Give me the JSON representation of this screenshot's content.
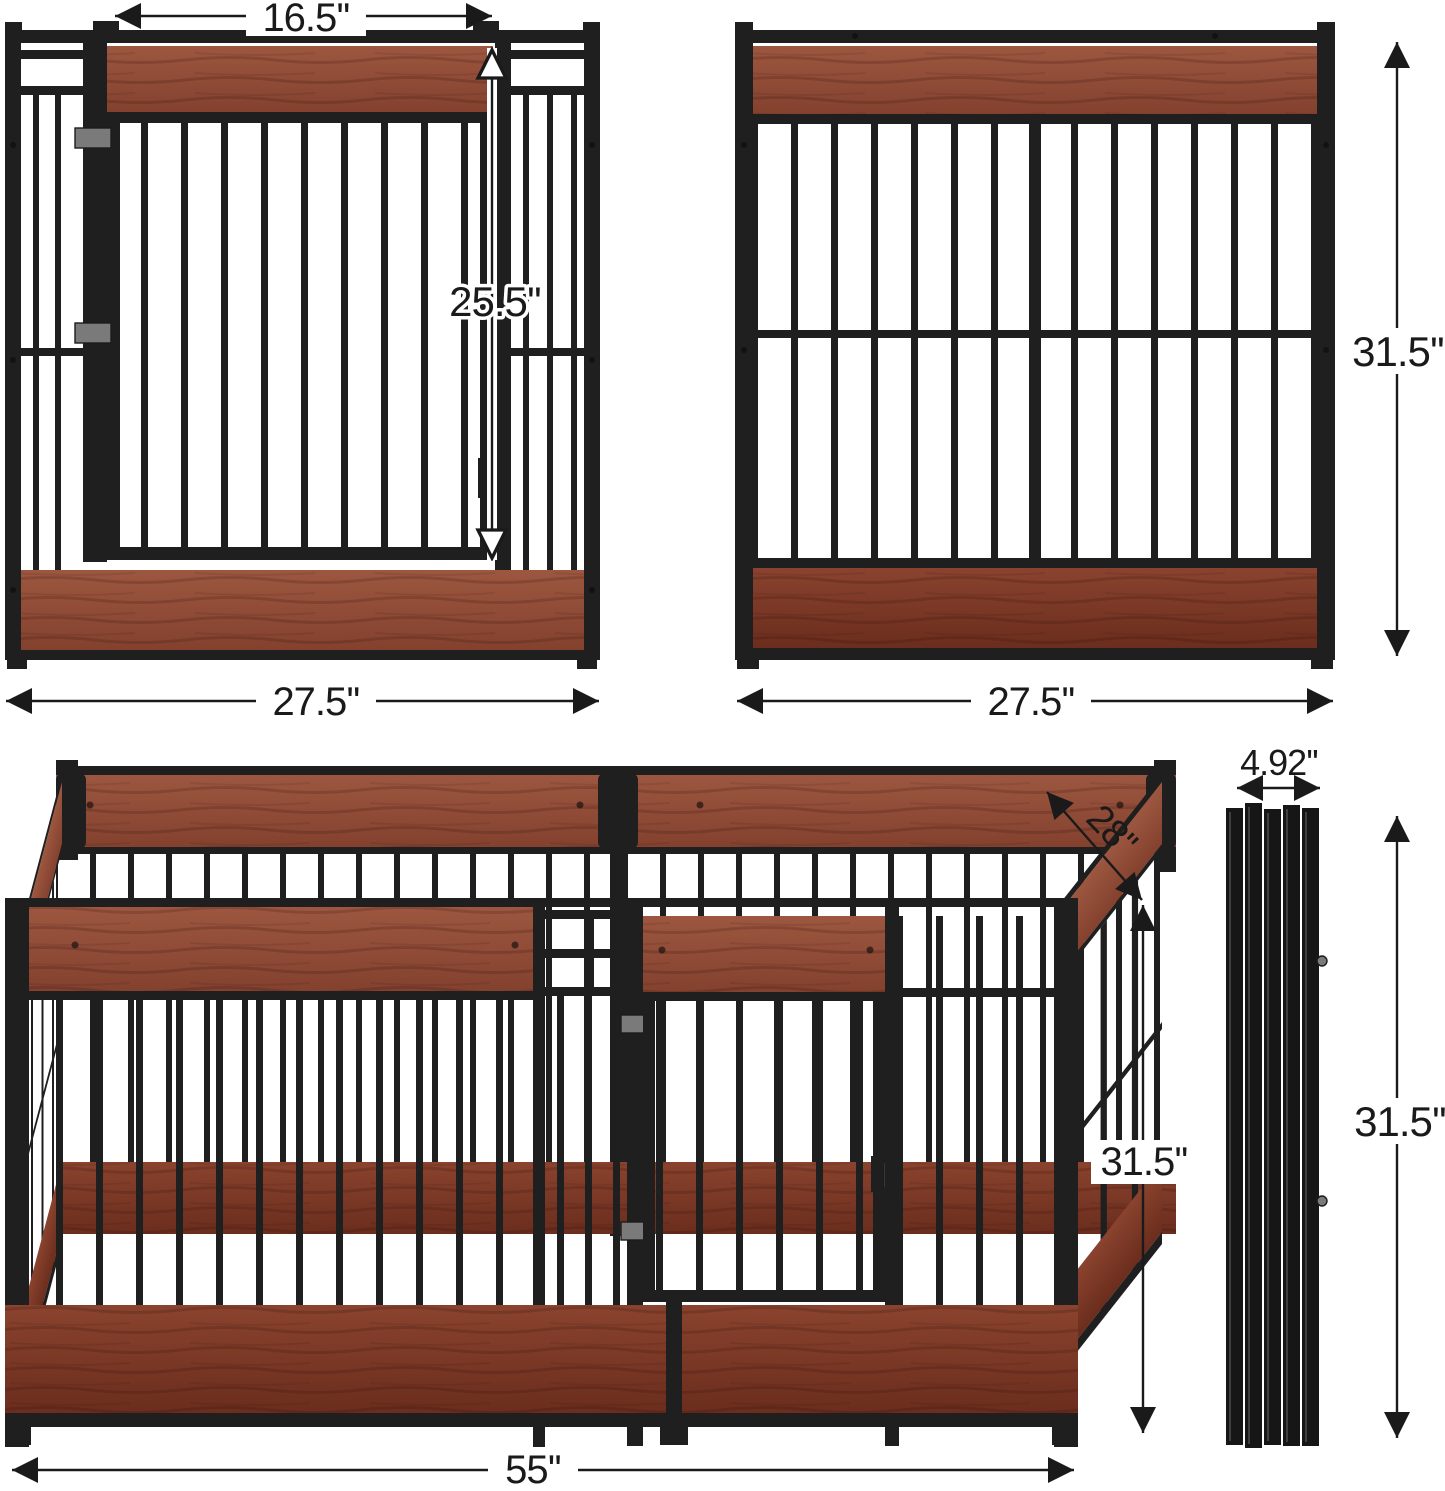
{
  "figure": {
    "description": "Dog crate panel dimension diagram",
    "background": "#ffffff",
    "colors": {
      "metal": "#1f1f1f",
      "metal_deep": "#161616",
      "wood_top": "#9d5740",
      "wood_bottom": "#83412e",
      "wood_dark_top": "#8a432e",
      "wood_dark_bottom": "#6b2d1d",
      "hinge": "#7a7a7a",
      "dimension": "#1a1a1a",
      "background": "#ffffff"
    }
  },
  "dimensions": {
    "door_width": {
      "label": "16.5''"
    },
    "door_height": {
      "label": "25.5''"
    },
    "panel_height": {
      "label": "31.5''"
    },
    "left_panel_width": {
      "label": "27.5''"
    },
    "right_panel_width": {
      "label": "27.5''"
    },
    "pen_depth": {
      "label": "28''"
    },
    "folded_width": {
      "label": "4.92''"
    },
    "pen_height": {
      "label": "31.5''"
    },
    "folded_height": {
      "label": "31.5''"
    },
    "pen_width": {
      "label": "55''"
    }
  }
}
